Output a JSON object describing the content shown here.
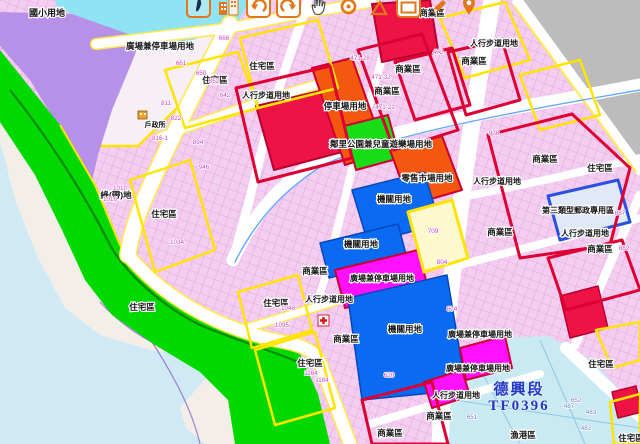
{
  "app": {
    "type": "urban-planning-map-viewer",
    "section_stamp": {
      "line1": "德興段",
      "line2": "TF0396",
      "color": "#2a35c8"
    }
  },
  "toolbar": {
    "buttons": [
      {
        "name": "overview-map-button",
        "icon": "taiwan-map-icon",
        "framed": true,
        "teal": true
      },
      {
        "name": "buildings-layer-button",
        "icon": "buildings-icon",
        "framed": false,
        "teal": false
      },
      {
        "name": "previous-view-button",
        "icon": "undo-arrow-icon",
        "framed": true,
        "teal": false
      },
      {
        "name": "next-view-button",
        "icon": "redo-arrow-icon",
        "framed": true,
        "teal": false
      },
      {
        "name": "pan-tool-button",
        "icon": "pan-hand-icon",
        "framed": false,
        "teal": false
      },
      {
        "name": "locate-point-button",
        "icon": "target-circle-icon",
        "framed": false,
        "teal": false
      },
      {
        "name": "measure-button",
        "icon": "triangle-ruler-icon",
        "framed": false,
        "teal": false
      },
      {
        "name": "zoom-box-button",
        "icon": "rectangle-select-icon",
        "framed": true,
        "teal": false
      },
      {
        "name": "draw-marker-button",
        "icon": "marker-pen-icon",
        "framed": false,
        "teal": false
      },
      {
        "name": "location-pin-button",
        "icon": "location-pin-icon",
        "framed": false,
        "teal": false
      }
    ]
  },
  "map": {
    "colors": {
      "residential_fabric": "#f3cef1",
      "residential_border": "#ffe400",
      "commercial_border": "#dd0033",
      "commercial_fill": "#ed1445",
      "school_purple": "#b791e8",
      "greenbelt": "#00d900",
      "park_green": "#16dd16",
      "parking_orange": "#f4570f",
      "institution_blue": "#0a6bf2",
      "plaza_magenta": "#ff10ff",
      "postal_border": "#2b50e0",
      "water": "#cfeaf4",
      "outside_gray": "#bcbcbc"
    },
    "zone_labels": [
      {
        "t": "國小用地",
        "x": 47,
        "y": 16,
        "s": 9
      },
      {
        "t": "廣場兼停車場用地",
        "x": 160,
        "y": 49,
        "s": 8.5
      },
      {
        "t": "住宅區",
        "x": 262,
        "y": 69,
        "s": 8.5
      },
      {
        "t": "住宅區",
        "x": 215,
        "y": 83,
        "s": 8.5
      },
      {
        "t": "人行步道用地",
        "x": 266,
        "y": 98,
        "s": 8
      },
      {
        "t": "停車場用地",
        "x": 345,
        "y": 109,
        "s": 8.5
      },
      {
        "t": "商業區",
        "x": 432,
        "y": 16,
        "s": 8.5
      },
      {
        "t": "人行步道用地",
        "x": 494,
        "y": 46,
        "s": 8
      },
      {
        "t": "商業區",
        "x": 474,
        "y": 64,
        "s": 8.5
      },
      {
        "t": "商業區",
        "x": 408,
        "y": 72,
        "s": 8.5
      },
      {
        "t": "商業區",
        "x": 387,
        "y": 94,
        "s": 8.5
      },
      {
        "t": "戶政所",
        "x": 155,
        "y": 127,
        "s": 7
      },
      {
        "t": "鄰里公園兼兒童遊樂場用地",
        "x": 381,
        "y": 147,
        "s": 8.5
      },
      {
        "t": "零售市場用地",
        "x": 427,
        "y": 181,
        "s": 8.5
      },
      {
        "t": "商業區",
        "x": 545,
        "y": 162,
        "s": 8.5
      },
      {
        "t": "住宅區",
        "x": 600,
        "y": 171,
        "s": 8.5
      },
      {
        "t": "人行步道用地",
        "x": 497,
        "y": 184,
        "s": 8
      },
      {
        "t": "綠(帶)地",
        "x": 116,
        "y": 198,
        "s": 8.5
      },
      {
        "t": "機關用地",
        "x": 394,
        "y": 202,
        "s": 8.5
      },
      {
        "t": "第三類型郵政專用區",
        "x": 578,
        "y": 213,
        "s": 8
      },
      {
        "t": "住宅區",
        "x": 164,
        "y": 217,
        "s": 8.5
      },
      {
        "t": "商業區",
        "x": 500,
        "y": 235,
        "s": 8.5
      },
      {
        "t": "人行步道用地",
        "x": 585,
        "y": 236,
        "s": 8
      },
      {
        "t": "機關用地",
        "x": 361,
        "y": 247,
        "s": 8.5
      },
      {
        "t": "商業區",
        "x": 600,
        "y": 252,
        "s": 8.5
      },
      {
        "t": "商業區",
        "x": 315,
        "y": 274,
        "s": 8.5
      },
      {
        "t": "廣場兼停車場用地",
        "x": 382,
        "y": 281,
        "s": 8
      },
      {
        "t": "人行步道用地",
        "x": 329,
        "y": 302,
        "s": 8
      },
      {
        "t": "住宅區",
        "x": 276,
        "y": 306,
        "s": 8.5
      },
      {
        "t": "住宅區",
        "x": 142,
        "y": 310,
        "s": 8.5
      },
      {
        "t": "機關用地",
        "x": 405,
        "y": 332,
        "s": 8.5
      },
      {
        "t": "廣場兼停車場用地",
        "x": 480,
        "y": 337,
        "s": 8
      },
      {
        "t": "商業區",
        "x": 346,
        "y": 342,
        "s": 8.5
      },
      {
        "t": "住宅區",
        "x": 310,
        "y": 366,
        "s": 8.5
      },
      {
        "t": "住宅區",
        "x": 601,
        "y": 367,
        "s": 8.5
      },
      {
        "t": "廣場兼停車場用地",
        "x": 478,
        "y": 371,
        "s": 8
      },
      {
        "t": "人行步道用地",
        "x": 456,
        "y": 398,
        "s": 8
      },
      {
        "t": "商業區",
        "x": 439,
        "y": 419,
        "s": 8.5
      },
      {
        "t": "商業區",
        "x": 390,
        "y": 436,
        "s": 8.5
      },
      {
        "t": "漁港區",
        "x": 523,
        "y": 438,
        "s": 8.5
      },
      {
        "t": "住宅區",
        "x": 631,
        "y": 441,
        "s": 8.5
      }
    ],
    "parcel_numbers": [
      {
        "t": "666",
        "x": 224,
        "y": 40
      },
      {
        "t": "661",
        "x": 181,
        "y": 65
      },
      {
        "t": "650",
        "x": 201,
        "y": 75
      },
      {
        "t": "852",
        "x": 214,
        "y": 83
      },
      {
        "t": "642",
        "x": 225,
        "y": 97
      },
      {
        "t": "811",
        "x": 166,
        "y": 105
      },
      {
        "t": "822",
        "x": 176,
        "y": 120
      },
      {
        "t": "816-1",
        "x": 160,
        "y": 140
      },
      {
        "t": "894",
        "x": 198,
        "y": 144
      },
      {
        "t": "946",
        "x": 204,
        "y": 169
      },
      {
        "t": "1010",
        "x": 120,
        "y": 190
      },
      {
        "t": "1016",
        "x": 110,
        "y": 201
      },
      {
        "t": "1034",
        "x": 177,
        "y": 244
      },
      {
        "t": "1048",
        "x": 288,
        "y": 310
      },
      {
        "t": "1095",
        "x": 282,
        "y": 327
      },
      {
        "t": "1164",
        "x": 311,
        "y": 375
      },
      {
        "t": "1184",
        "x": 322,
        "y": 382
      },
      {
        "t": "471-28",
        "x": 360,
        "y": 60
      },
      {
        "t": "471-32",
        "x": 381,
        "y": 79
      },
      {
        "t": "471-21",
        "x": 385,
        "y": 109
      },
      {
        "t": "472",
        "x": 438,
        "y": 54
      },
      {
        "t": "978",
        "x": 494,
        "y": 135
      },
      {
        "t": "887",
        "x": 620,
        "y": 215
      },
      {
        "t": "882",
        "x": 624,
        "y": 250
      },
      {
        "t": "709",
        "x": 433,
        "y": 233
      },
      {
        "t": "620",
        "x": 389,
        "y": 377
      },
      {
        "t": "804",
        "x": 442,
        "y": 264
      },
      {
        "t": "874",
        "x": 452,
        "y": 311
      }
    ],
    "harbor_numbers": [
      {
        "t": "651",
        "x": 472,
        "y": 419
      },
      {
        "t": "652",
        "x": 576,
        "y": 402
      },
      {
        "t": "487",
        "x": 569,
        "y": 408
      },
      {
        "t": "483",
        "x": 591,
        "y": 414
      },
      {
        "t": "482",
        "x": 586,
        "y": 430
      }
    ]
  }
}
